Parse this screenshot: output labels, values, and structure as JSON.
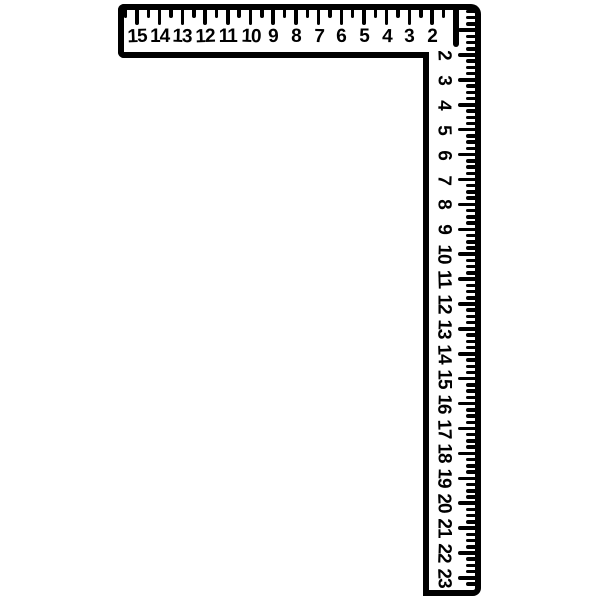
{
  "figure": {
    "description": "framing square (L-shaped carpenter's ruler), black line art on white",
    "ink_color": "#000000",
    "background_color": "#ffffff",
    "horizontal_scale": {
      "numbers": [
        "15",
        "14",
        "13",
        "12",
        "11",
        "10",
        "9",
        "8",
        "7",
        "6",
        "5",
        "4",
        "3",
        "2"
      ],
      "divisions_per_unit": 2,
      "tick_edge": "top"
    },
    "vertical_scale": {
      "numbers": [
        "2",
        "3",
        "4",
        "5",
        "6",
        "7",
        "8",
        "9",
        "10",
        "11",
        "12",
        "13",
        "14",
        "15",
        "16",
        "17",
        "18",
        "19",
        "20",
        "21",
        "22",
        "23"
      ],
      "divisions_per_unit": 4,
      "tick_edge": "right",
      "number_rotation_deg": 90
    }
  }
}
